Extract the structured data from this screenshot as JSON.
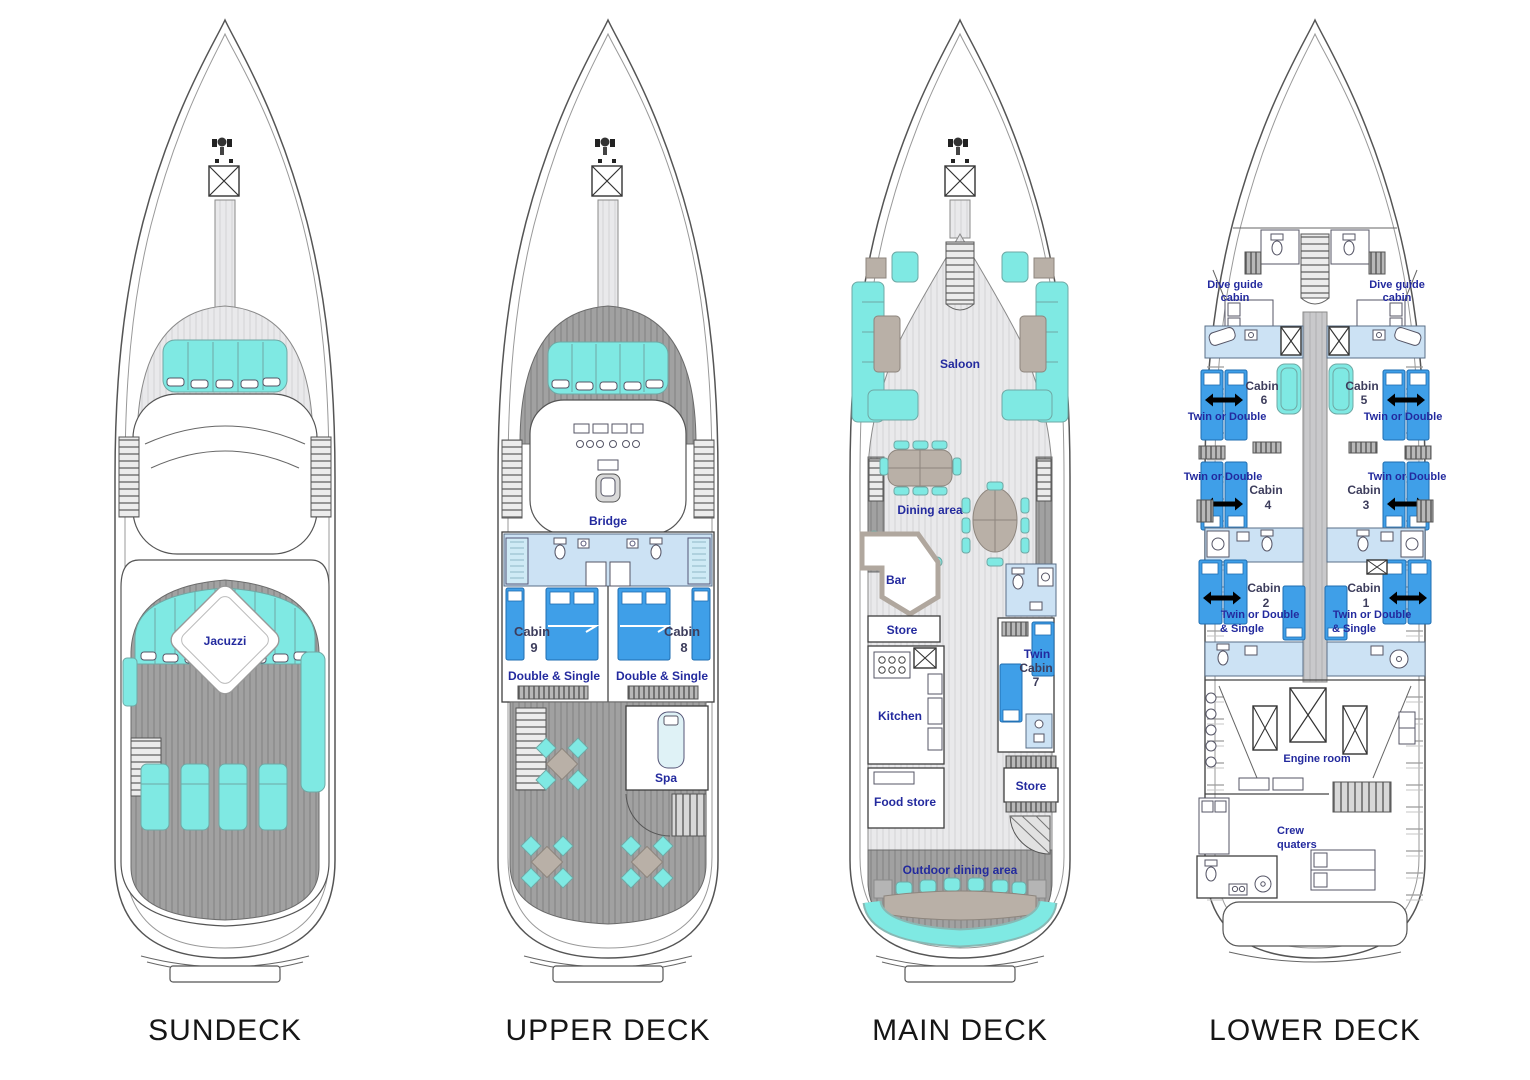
{
  "page": {
    "background": "#ffffff",
    "type": "yacht-deck-plan"
  },
  "decks": {
    "sundeck": {
      "title": "SUNDECK",
      "labels": {
        "jacuzzi": "Jacuzzi"
      }
    },
    "upper": {
      "title": "UPPER DECK",
      "labels": {
        "bridge": "Bridge",
        "cabin9_name": "Cabin",
        "cabin9_number": "9",
        "cabin9_type": "Double & Single",
        "cabin8_name": "Cabin",
        "cabin8_number": "8",
        "cabin8_type": "Double & Single",
        "spa": "Spa"
      }
    },
    "main": {
      "title": "MAIN DECK",
      "labels": {
        "saloon": "Saloon",
        "dining_area": "Dining area",
        "bar": "Bar",
        "store_forward": "Store",
        "kitchen": "Kitchen",
        "food_store": "Food store",
        "cabin7_line1": "Twin",
        "cabin7_line2": "Cabin",
        "cabin7_line3": "7",
        "store_aft": "Store",
        "outdoor_dining": "Outdoor dining area"
      }
    },
    "lower": {
      "title": "LOWER DECK",
      "labels": {
        "dive_guide_line1": "Dive guide",
        "dive_guide_line2": "cabin",
        "cabin6_name": "Cabin",
        "cabin6_number": "6",
        "cabin6_type": "Twin or Double",
        "cabin5_name": "Cabin",
        "cabin5_number": "5",
        "cabin5_type": "Twin or Double",
        "cabin4_name": "Cabin",
        "cabin4_number": "4",
        "cabin4_type": "Twin or Double",
        "cabin3_name": "Cabin",
        "cabin3_number": "3",
        "cabin3_type": "Twin or Double",
        "cabin2_name": "Cabin",
        "cabin2_number": "2",
        "cabin2_type_line1": "Twin or Double",
        "cabin2_type_line2": "& Single",
        "cabin1_name": "Cabin",
        "cabin1_number": "1",
        "cabin1_type_line1": "Twin or Double",
        "cabin1_type_line2": "& Single",
        "engine_room": "Engine room",
        "crew_line1": "Crew",
        "crew_line2": "quaters"
      }
    }
  },
  "colors": {
    "furniture_cyan": "#7FE9E3",
    "bed_blue": "#3F9FE8",
    "bathroom_blue": "#CCE2F4",
    "label_navy": "#232A9E",
    "deck_wood_gray": "#A1A1A1",
    "floor_light_gray": "#E9E9EB",
    "furniture_taupe": "#B9B0A7",
    "title_black": "#161616"
  }
}
